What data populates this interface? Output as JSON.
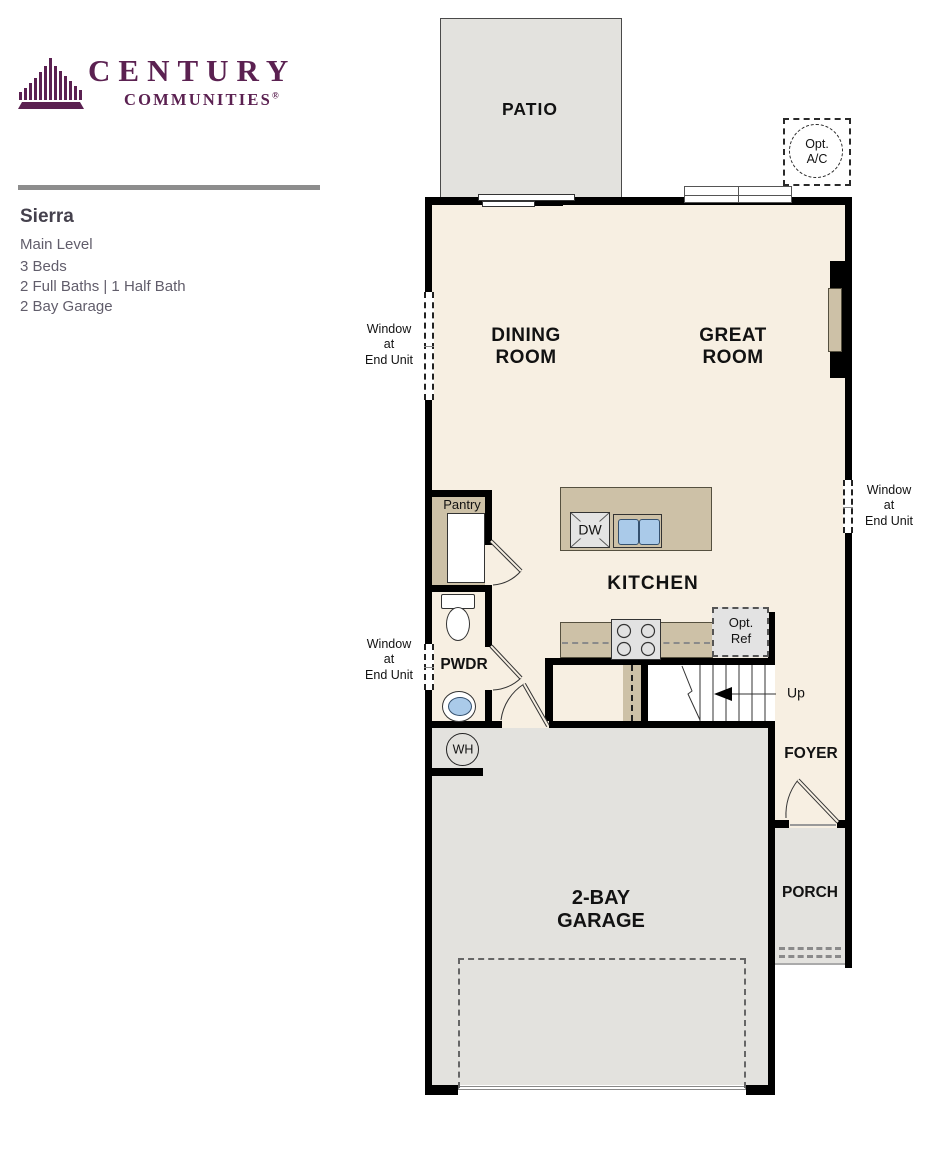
{
  "colors": {
    "brand_purple": "#5b2151",
    "floor_cream": "#f7efe2",
    "floor_gray": "#e3e2de",
    "counter_tan": "#cdc1a7",
    "sink_blue": "#aacae9",
    "wall_black": "#000000",
    "info_text": "#615d6b"
  },
  "brand": {
    "word1": "CENTURY",
    "word2": "COMMUNITIES",
    "reg": "®"
  },
  "info": {
    "title": "Sierra",
    "lines": [
      "Main Level",
      "3 Beds",
      "2 Full Baths | 1 Half Bath",
      "2 Bay Garage"
    ]
  },
  "floorplan": {
    "patio": "PATIO",
    "dining": {
      "l1": "DINING",
      "l2": "ROOM"
    },
    "great": {
      "l1": "GREAT",
      "l2": "ROOM"
    },
    "kitchen": "KITCHEN",
    "pantry": "Pantry",
    "pwdr": "PWDR",
    "foyer": "FOYER",
    "porch": "PORCH",
    "garage": {
      "l1": "2-BAY",
      "l2": "GARAGE"
    },
    "opt_ac": {
      "l1": "Opt.",
      "l2": "A/C"
    },
    "opt_ref": {
      "l1": "Opt.",
      "l2": "Ref"
    },
    "dw": "DW",
    "wh": "WH",
    "up": "Up",
    "window_note": {
      "l1": "Window",
      "l2": "at",
      "l3": "End Unit"
    }
  }
}
